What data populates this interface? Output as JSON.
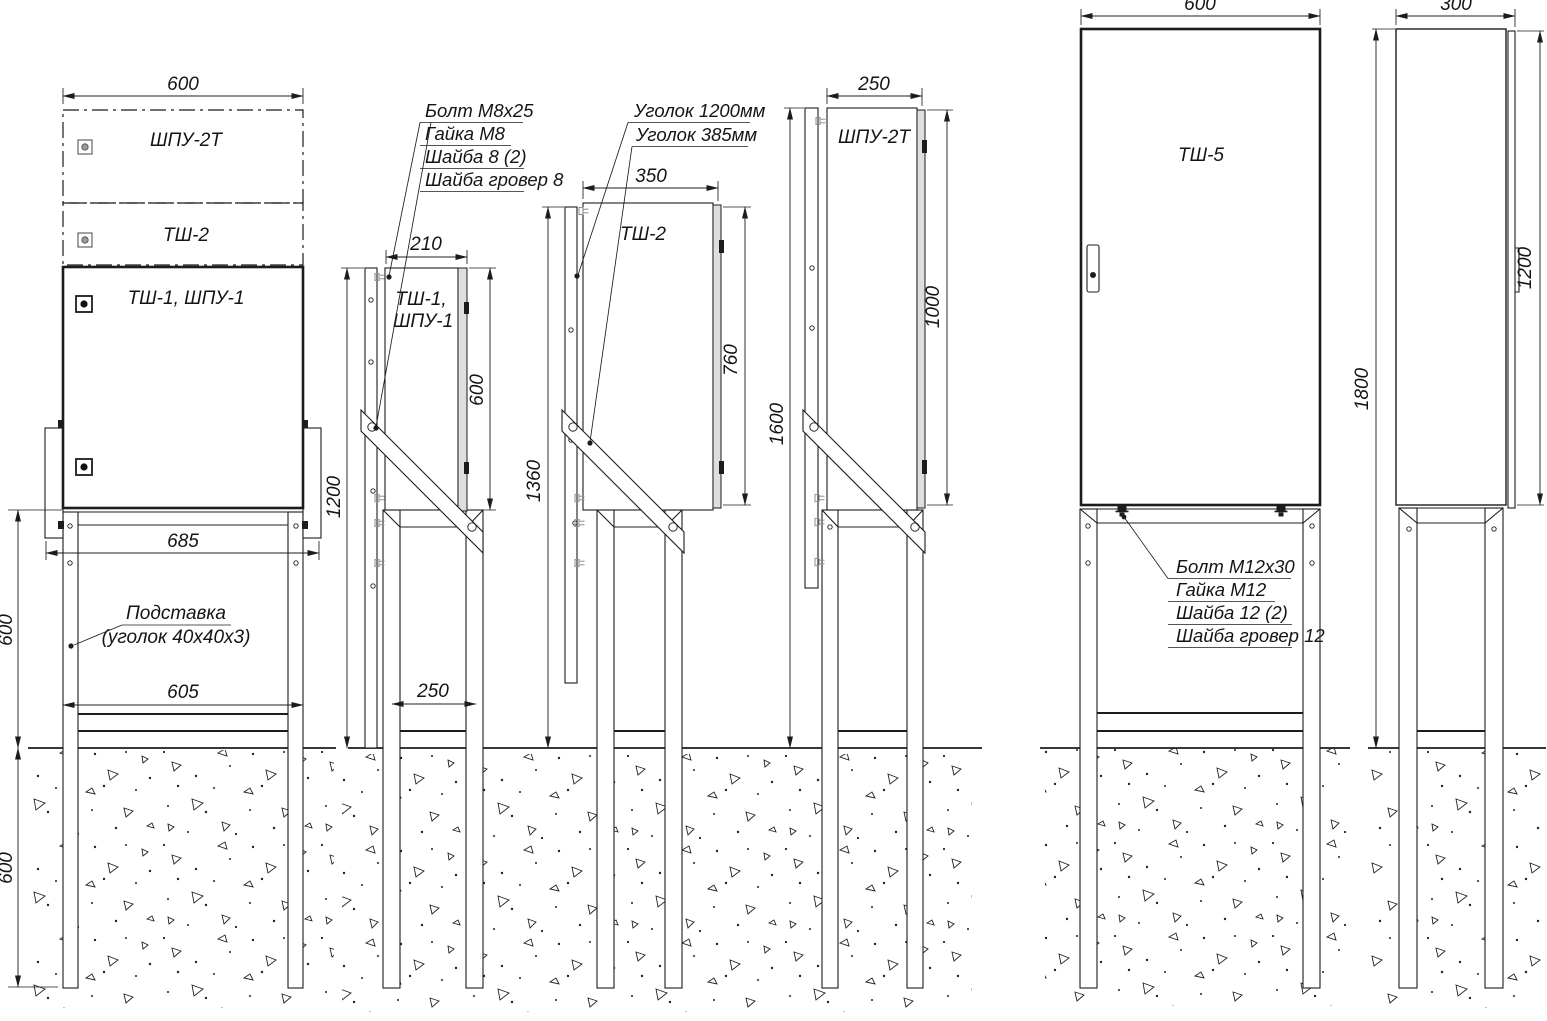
{
  "views": {
    "front_stack": {
      "dim_width_top": "600",
      "label_box1": "ШПУ-2Т",
      "label_box2": "ТШ-2",
      "label_box3": "ТШ-1,  ШПУ-1",
      "dim_bracket_span": "685",
      "dim_leg_span": "605",
      "dim_stand_height": "600",
      "dim_buried_depth": "600",
      "callout_stand_title": "Подставка",
      "callout_stand_note": "(уголок 40х40х3)"
    },
    "side_tsh1": {
      "callout_bolt": "Болт  М8х25",
      "callout_nut": "Гайка  М8",
      "callout_washer": "Шайба 8  (2)",
      "callout_spring_washer": "Шайба гровер 8",
      "dim_depth_top": "210",
      "dim_total_height": "1200",
      "dim_cabinet_height": "600",
      "dim_leg_span": "250",
      "label_line1": "ТШ-1,",
      "label_line2": "ШПУ-1"
    },
    "side_tsh2": {
      "callout_angle_long": "Уголок 1200мм",
      "callout_angle_short": "Уголок 385мм",
      "dim_depth_top": "350",
      "dim_total_height": "1360",
      "dim_cabinet_height": "760",
      "label": "ТШ-2"
    },
    "side_shpu2t": {
      "dim_depth_top": "250",
      "dim_total_height": "1600",
      "dim_cabinet_height": "1000",
      "label": "ШПУ-2Т"
    },
    "front_tsh5": {
      "dim_width_top": "600",
      "label": "ТШ-5",
      "callout_bolt": "Болт  М12х30",
      "callout_nut": "Гайка  М12",
      "callout_washer": "Шайба 12  (2)",
      "callout_spring_washer": "Шайба гровер 12"
    },
    "side_tsh5": {
      "dim_width_top": "300",
      "dim_total_height": "1800",
      "dim_cabinet_height": "1200"
    }
  }
}
